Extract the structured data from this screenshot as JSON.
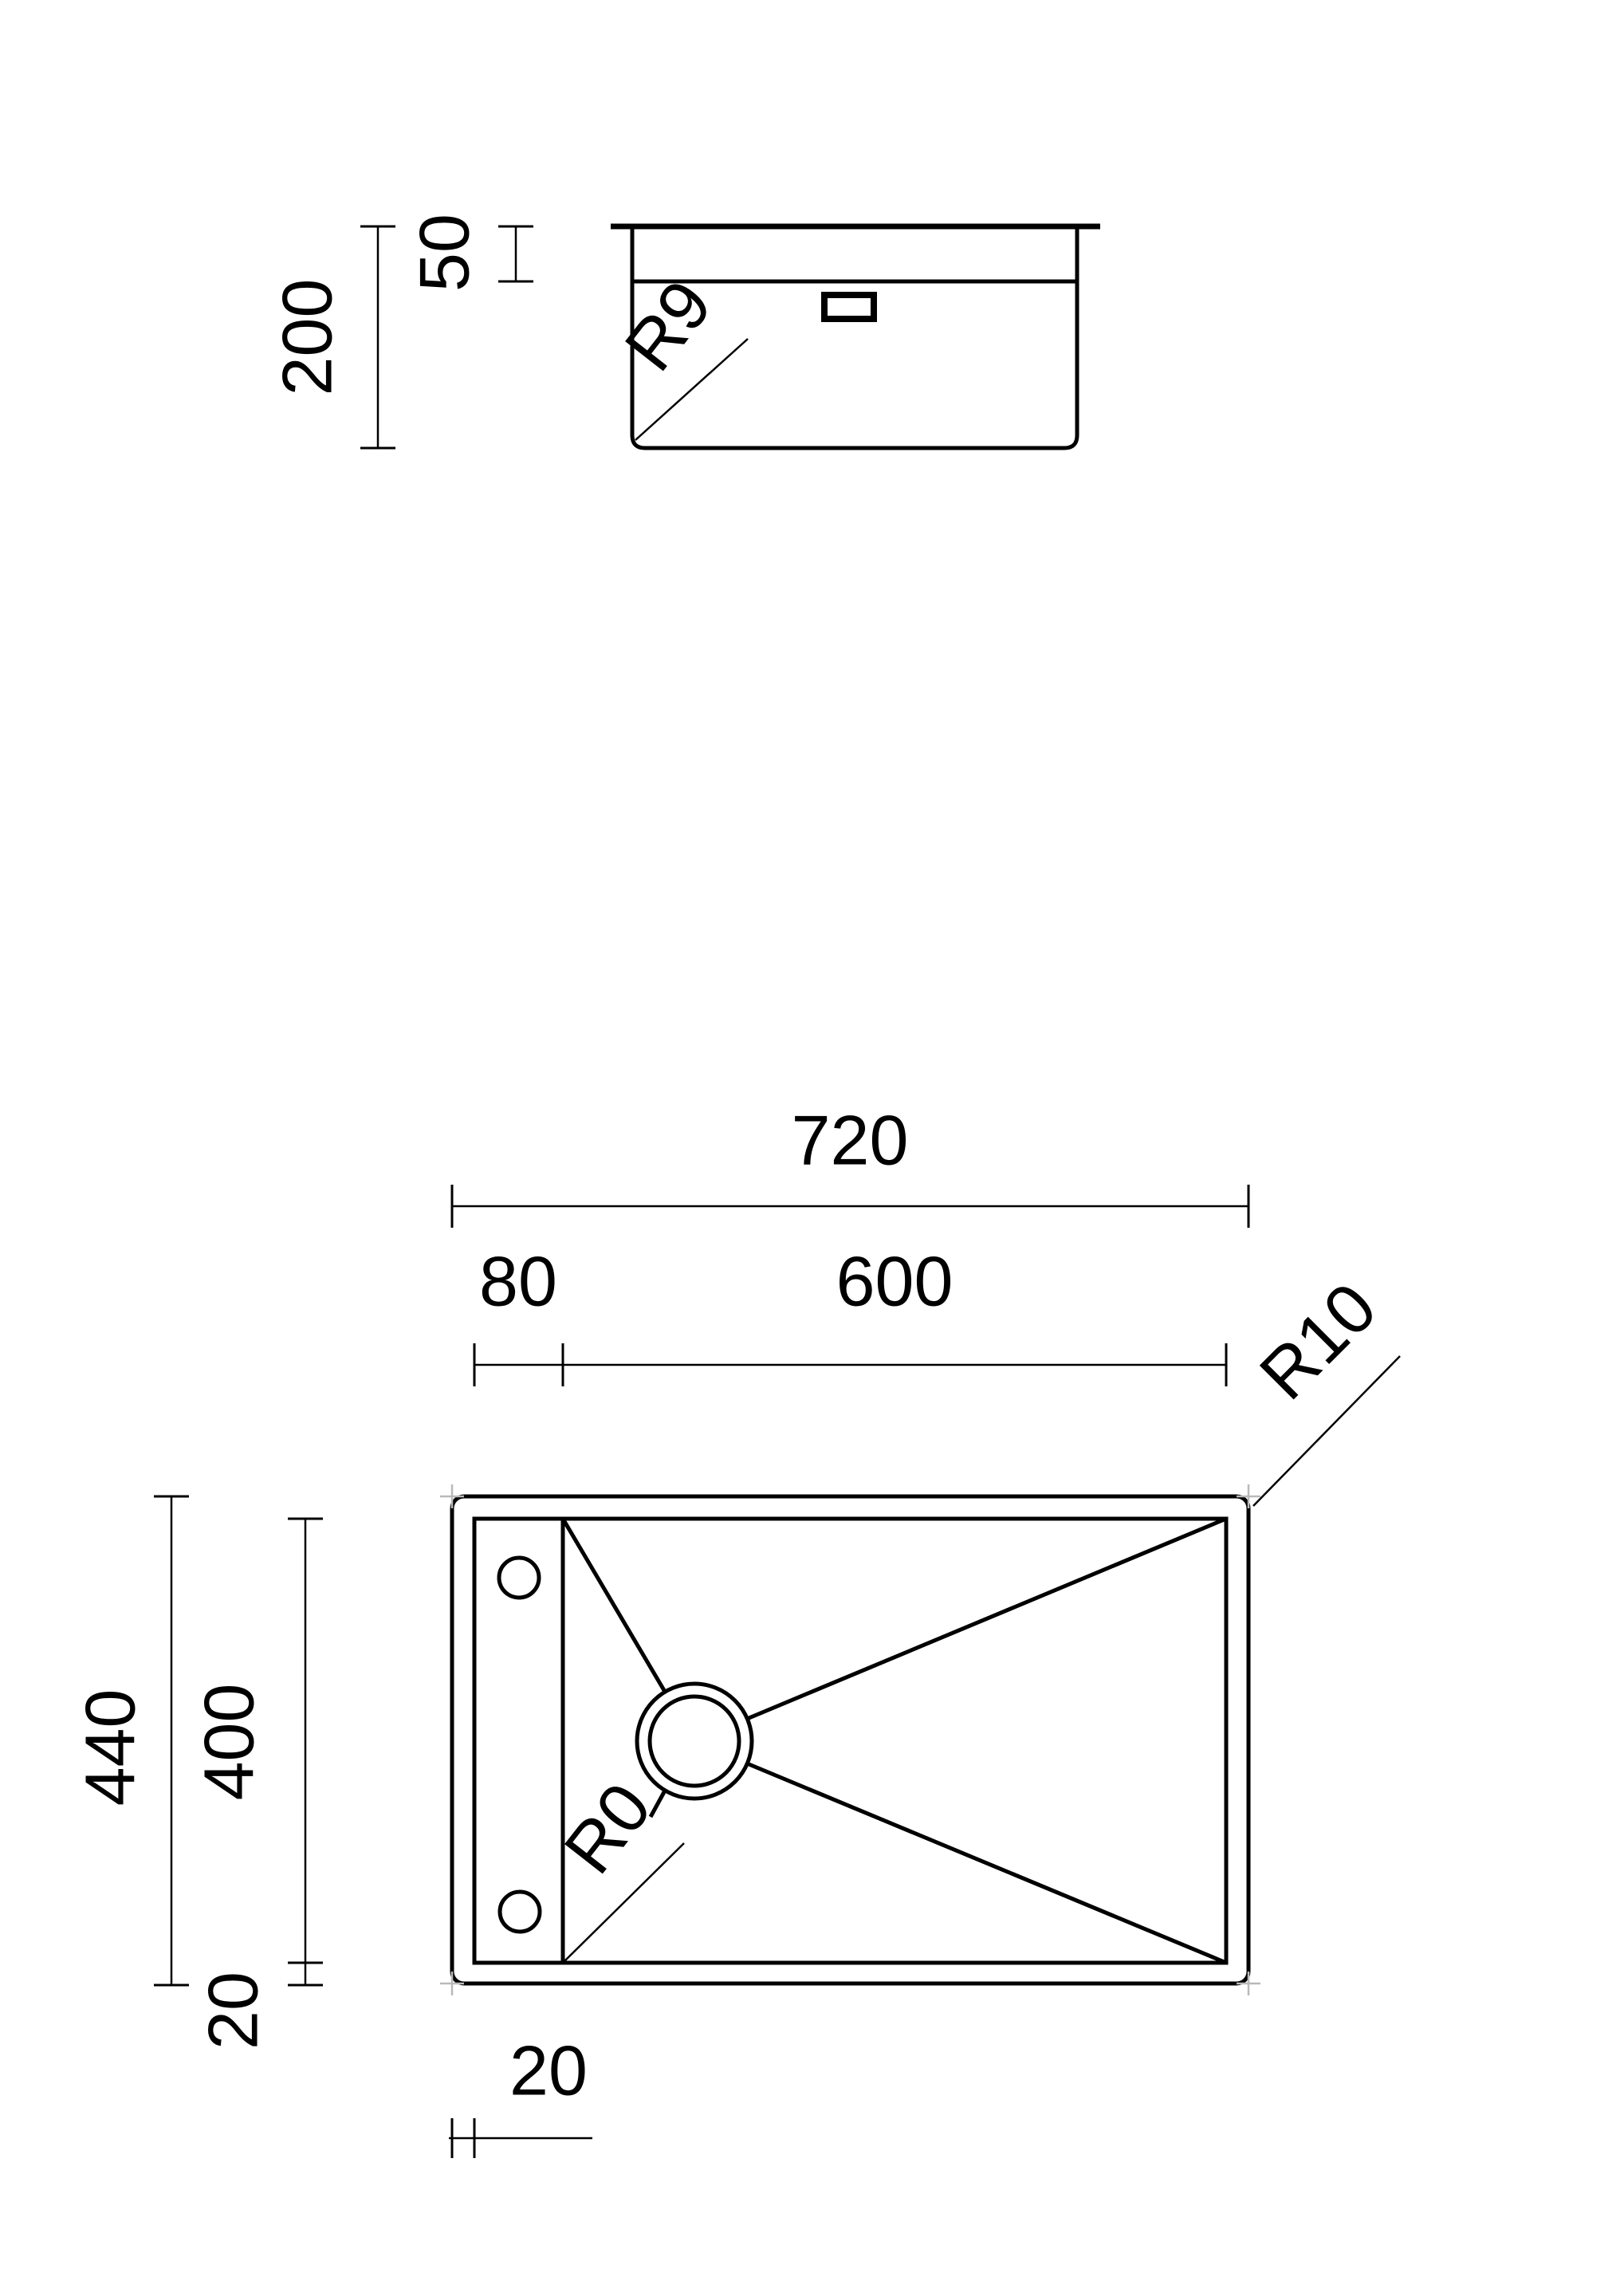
{
  "drawing": {
    "type": "sink-technical-drawing",
    "background_color": "#ffffff",
    "line_color": "#000000",
    "corner_marker_color": "#b9b9b9",
    "section_view": {
      "total_depth": "200",
      "rim_depth": "50",
      "bottom_corner_radius": "R9"
    },
    "plan_view": {
      "total_width": "720",
      "ledge_width": "80",
      "bowl_width": "600",
      "outer_corner_radius": "R10",
      "total_depth": "440",
      "bowl_depth": "400",
      "left_rim_width": "20",
      "bottom_rim_width": "20",
      "bowl_corner_radius": "R0"
    }
  }
}
